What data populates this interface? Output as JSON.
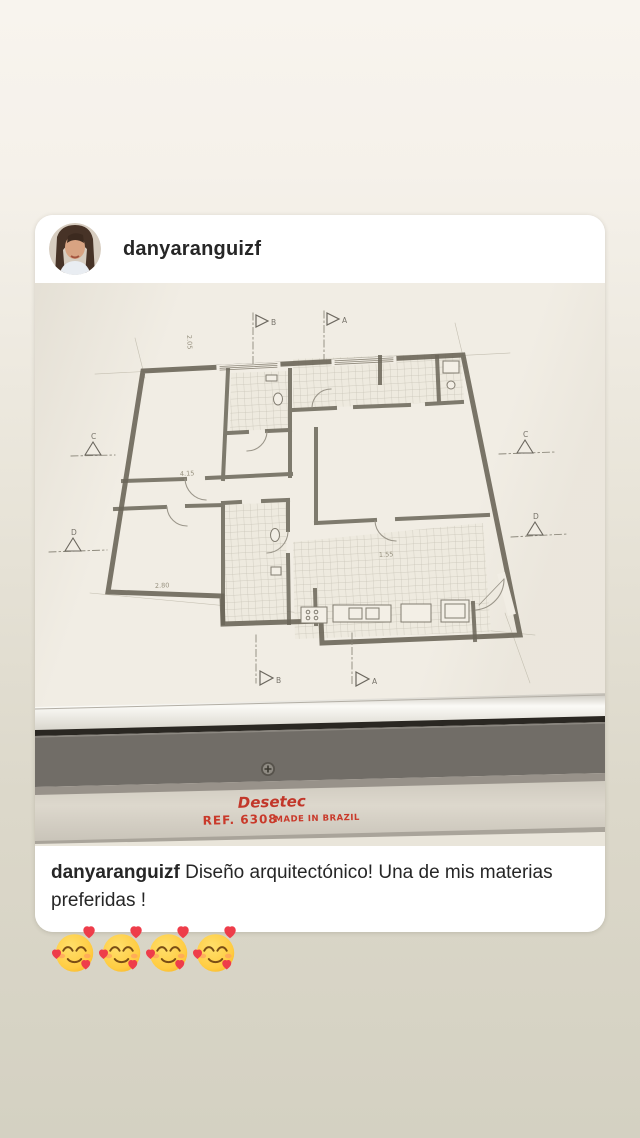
{
  "header": {
    "username": "danyaranguizf"
  },
  "caption": {
    "username": "danyaranguizf",
    "text": "Diseño arquitectónico! Una de mis materias preferidas !"
  },
  "photo": {
    "description": "hand-drawn architectural floor plan on drafting table",
    "ruler": {
      "brand": "Desetec",
      "ref": "REF. 6308",
      "made": "MADE IN BRAZIL",
      "text_color": "#c2372a"
    },
    "plan": {
      "markers": [
        {
          "letter": "B"
        },
        {
          "letter": "A"
        },
        {
          "letter": "B"
        },
        {
          "letter": "A"
        },
        {
          "letter": "C"
        },
        {
          "letter": "C"
        },
        {
          "letter": "D"
        },
        {
          "letter": "D"
        }
      ],
      "dimensions": [
        "4.15",
        "2.80",
        "1.55",
        "2.05"
      ]
    },
    "colors": {
      "paper": "#f1ede4",
      "pencil": "#6b6659",
      "ruler_dark_band": "#716d67",
      "ruler_cream_band": "#d8d3c8"
    }
  },
  "reactions": {
    "emoji_name": "smiling-face-with-hearts",
    "count": 4,
    "label": "🥰🥰🥰🥰"
  }
}
